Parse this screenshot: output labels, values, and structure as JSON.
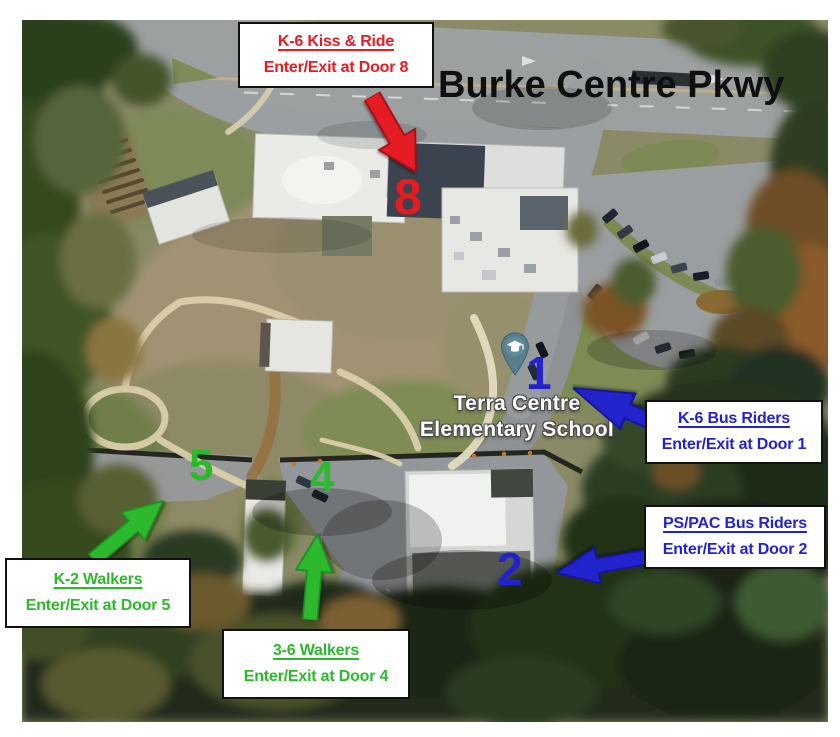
{
  "road_label": "Burke Centre Pkwy",
  "school": {
    "name_line1": "Terra Centre",
    "name_line2": "Elementary School",
    "pin_icon": "graduation-cap-pin"
  },
  "legend": {
    "kiss_ride": {
      "title": "K-6 Kiss & Ride",
      "subtitle": "Enter/Exit at Door 8",
      "door_number": "8",
      "color": "#e51c23"
    },
    "k6_bus": {
      "title": "K-6 Bus Riders",
      "subtitle": "Enter/Exit at Door 1",
      "door_number": "1",
      "color": "#2323cd"
    },
    "pspac_bus": {
      "title": "PS/PAC Bus Riders",
      "subtitle": "Enter/Exit at Door 2",
      "door_number": "2",
      "color": "#2323cd"
    },
    "k2_walkers": {
      "title": "K-2 Walkers",
      "subtitle": "Enter/Exit at Door 5",
      "door_number": "5",
      "color": "#2db92d"
    },
    "walkers_3_6": {
      "title": "3-6 Walkers",
      "subtitle": "Enter/Exit at Door 4",
      "door_number": "4",
      "color": "#2db92d"
    }
  },
  "colors": {
    "kiss_ride_red": "#e51c23",
    "bus_blue": "#2323cd",
    "walker_green": "#2db92d",
    "road_text": "#0f0f0f"
  }
}
